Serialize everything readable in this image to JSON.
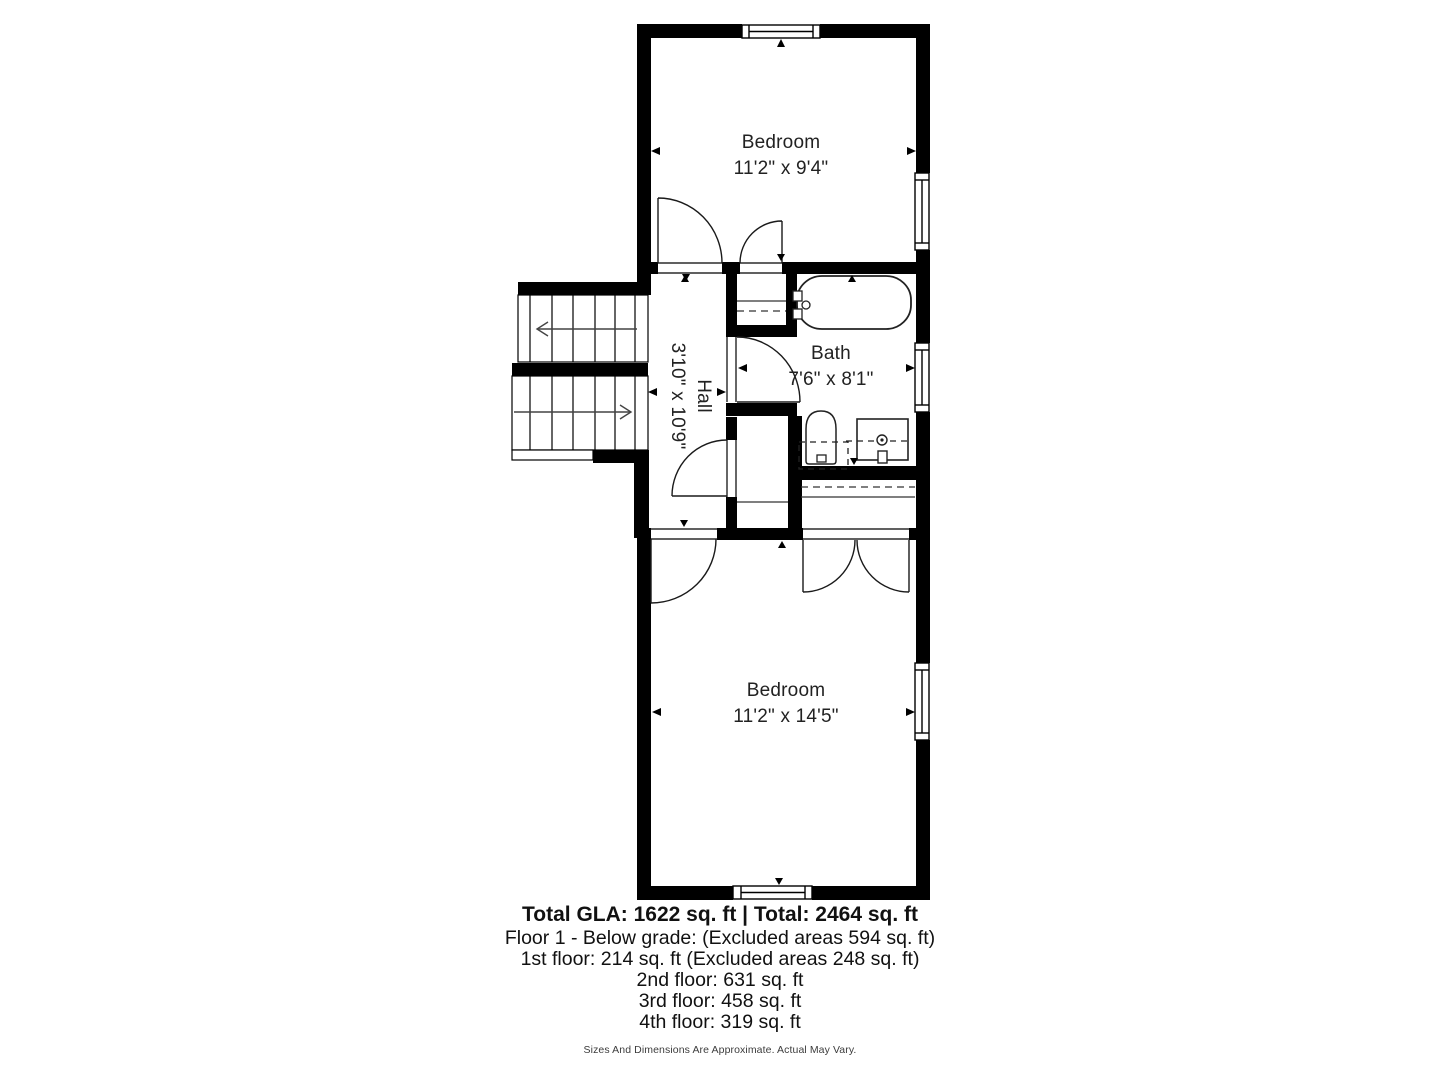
{
  "plan": {
    "rooms": {
      "bedroom_top": {
        "label": "Bedroom",
        "dims": "11'2\" x 9'4\""
      },
      "hall": {
        "label": "Hall",
        "dims": "3'10\" x 10'9\""
      },
      "bath": {
        "label": "Bath",
        "dims": "7'6\" x 8'1\""
      },
      "bedroom_bottom": {
        "label": "Bedroom",
        "dims": "11'2\" x 14'5\""
      }
    }
  },
  "footer": {
    "total": "Total GLA: 1622 sq. ft | Total: 2464 sq. ft",
    "lines": [
      "Floor 1 - Below grade: (Excluded areas 594 sq. ft)",
      "1st floor: 214 sq. ft (Excluded areas 248 sq. ft)",
      "2nd floor: 631 sq. ft",
      "3rd floor: 458 sq. ft",
      "4th floor: 319 sq. ft"
    ],
    "disclaimer": "Sizes And Dimensions Are Approximate. Actual May Vary."
  },
  "colors": {
    "wall": "#000000",
    "background": "#ffffff",
    "text": "#222222"
  }
}
